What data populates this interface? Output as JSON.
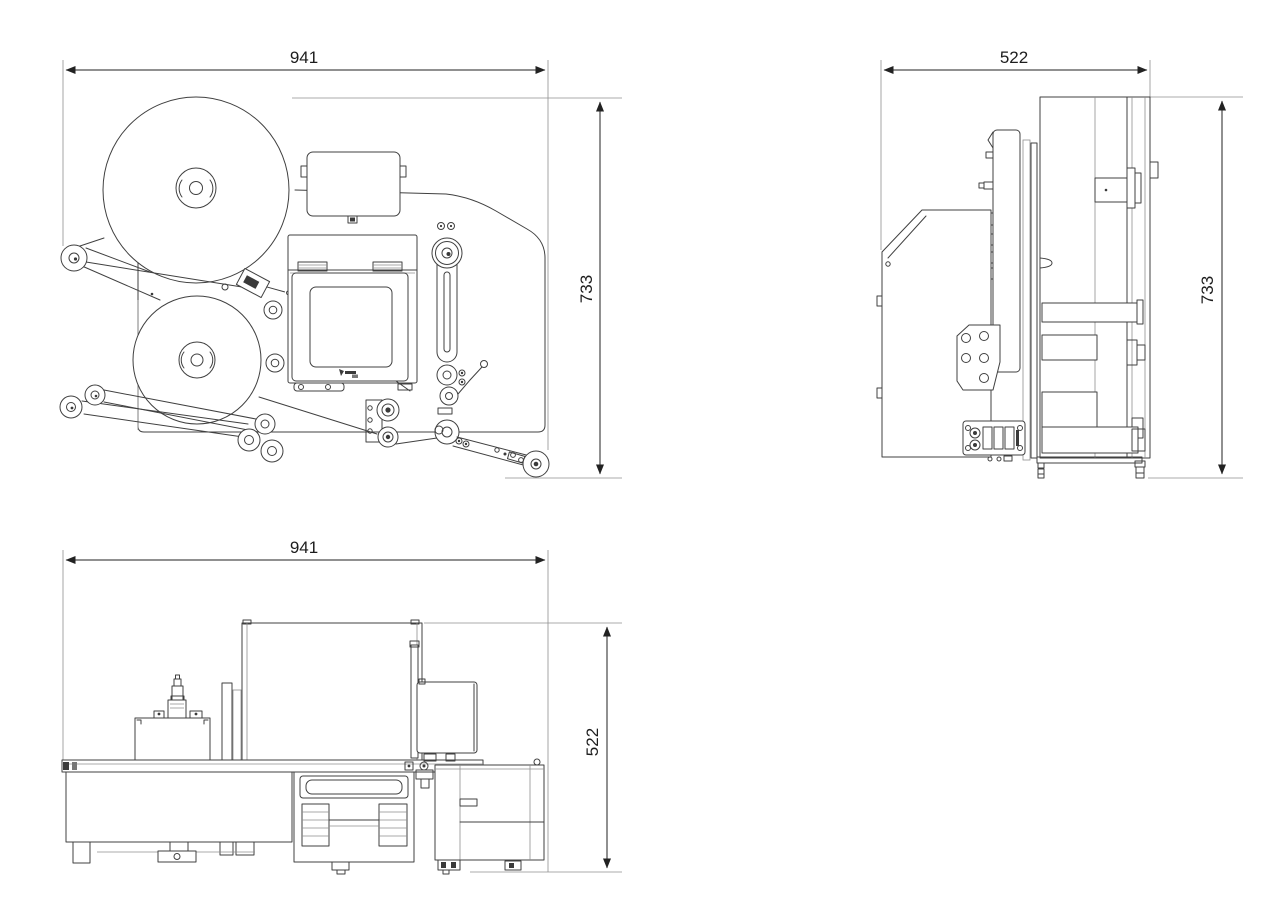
{
  "document": {
    "kind": "technical-drawing",
    "views": [
      {
        "id": "front",
        "label": "front-view"
      },
      {
        "id": "side",
        "label": "side-view"
      },
      {
        "id": "top",
        "label": "top-view"
      }
    ],
    "dimensions": {
      "front_width": "941",
      "front_height": "733",
      "side_width": "522",
      "side_height": "733",
      "top_width": "941",
      "top_height": "522"
    },
    "icons": {
      "printer_logo": "zebra-logo-mark"
    },
    "colors": {
      "line": "#404040",
      "dim_line": "#222222",
      "light_line": "#8f8f8f",
      "background": "#ffffff"
    }
  }
}
